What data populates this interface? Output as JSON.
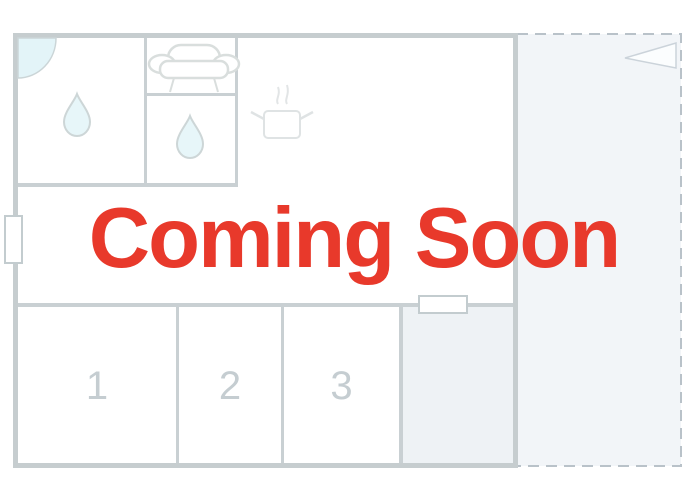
{
  "overlay": {
    "title": "Coming Soon",
    "color": "#e8392b"
  },
  "floorplan": {
    "room_labels": [
      "1",
      "2",
      "3"
    ],
    "icons": [
      {
        "name": "door-arc-icon",
        "meaning": "door swing in top-left room"
      },
      {
        "name": "water-drop-icon",
        "meaning": "bathroom / water point, left room"
      },
      {
        "name": "water-drop-icon",
        "meaning": "bathroom / water point, small middle room"
      },
      {
        "name": "sofa-icon",
        "meaning": "living / lounge furniture"
      },
      {
        "name": "cooking-pot-icon",
        "meaning": "kitchen"
      },
      {
        "name": "pennant-flag-icon",
        "meaning": "terrace marker, top right"
      }
    ],
    "colors": {
      "wall": "#c6cdcf",
      "interior_wall": "#c9d0d3",
      "accent_red": "#e8392b",
      "terrace_fill": "#f2f5f8",
      "shaded_room_fill": "#eef2f5",
      "drop_fill": "#e7f6f9",
      "door_arc_fill": "#e3f4f8",
      "label_gray": "#c5cdd1",
      "dash_gray": "#b9c2c9"
    }
  }
}
